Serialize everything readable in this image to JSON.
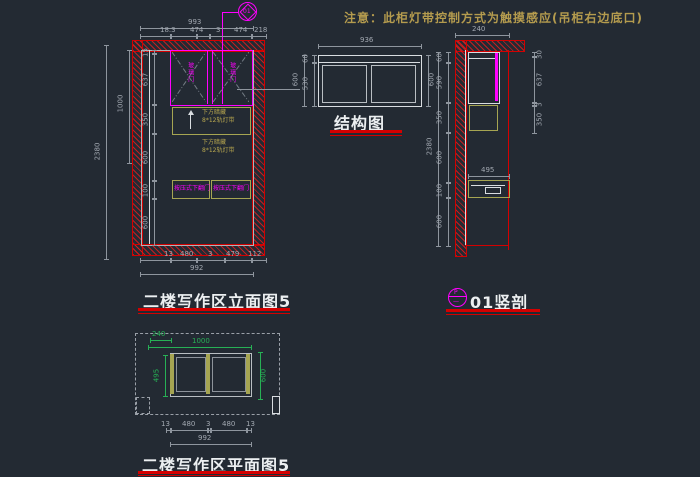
{
  "note": {
    "text": "注意：此柜灯带控制方式为触摸感应(吊柜右边底口)"
  },
  "views": {
    "elevation": {
      "title": "二楼写作区立面图5",
      "callout_number": "01",
      "door_left_label": "玻璃门",
      "door_right_label": "玻璃门",
      "niche_label_line1": "下方暗藏",
      "niche_label_line2": "8*12轨灯带",
      "drawer_left_label": "按压式下翻门",
      "drawer_right_label": "按压式下翻门",
      "dims": {
        "top_overall": "993",
        "top_chain": [
          "18.3",
          "474",
          "3",
          "474",
          "218"
        ],
        "bottom_chain": [
          "13",
          "480",
          "3",
          "479",
          "112"
        ],
        "bottom_overall": "992",
        "left_outer": "2380",
        "left_mid": "1000",
        "left_chain": [
          "15",
          "637",
          "350",
          "600",
          "100",
          "600"
        ]
      }
    },
    "structure": {
      "title": "结构图",
      "dims": {
        "top": "936",
        "left_outer": "600",
        "left_chain": [
          "60",
          "530"
        ],
        "right": "600"
      }
    },
    "section": {
      "title": "01竖剖",
      "bubble_top": "P",
      "bubble_bottom": "—",
      "dims": {
        "top": "240",
        "left_outer": "2380",
        "left_chain": [
          "60",
          "590",
          "350",
          "600",
          "100",
          "600"
        ],
        "right_chain": [
          "30",
          "637",
          "3",
          "350"
        ],
        "drawer_width": "495"
      }
    },
    "plan": {
      "title": "二楼写作区平面图5",
      "dims": {
        "green_top_short": "240",
        "green_top_long": "1000",
        "green_left": "495",
        "green_right": "600",
        "bottom_chain": [
          "13",
          "480",
          "3",
          "480",
          "13"
        ],
        "bottom_overall": "992"
      }
    }
  },
  "colors": {
    "background": "#232a33",
    "wall_red": "#d40000",
    "cabinet_magenta": "#ff00ff",
    "panel_olive": "#a6a552",
    "dimension_gray": "#8e959e",
    "note_yellow": "#b49b4e",
    "plan_green": "#27b055",
    "title_white": "#eceff1"
  }
}
